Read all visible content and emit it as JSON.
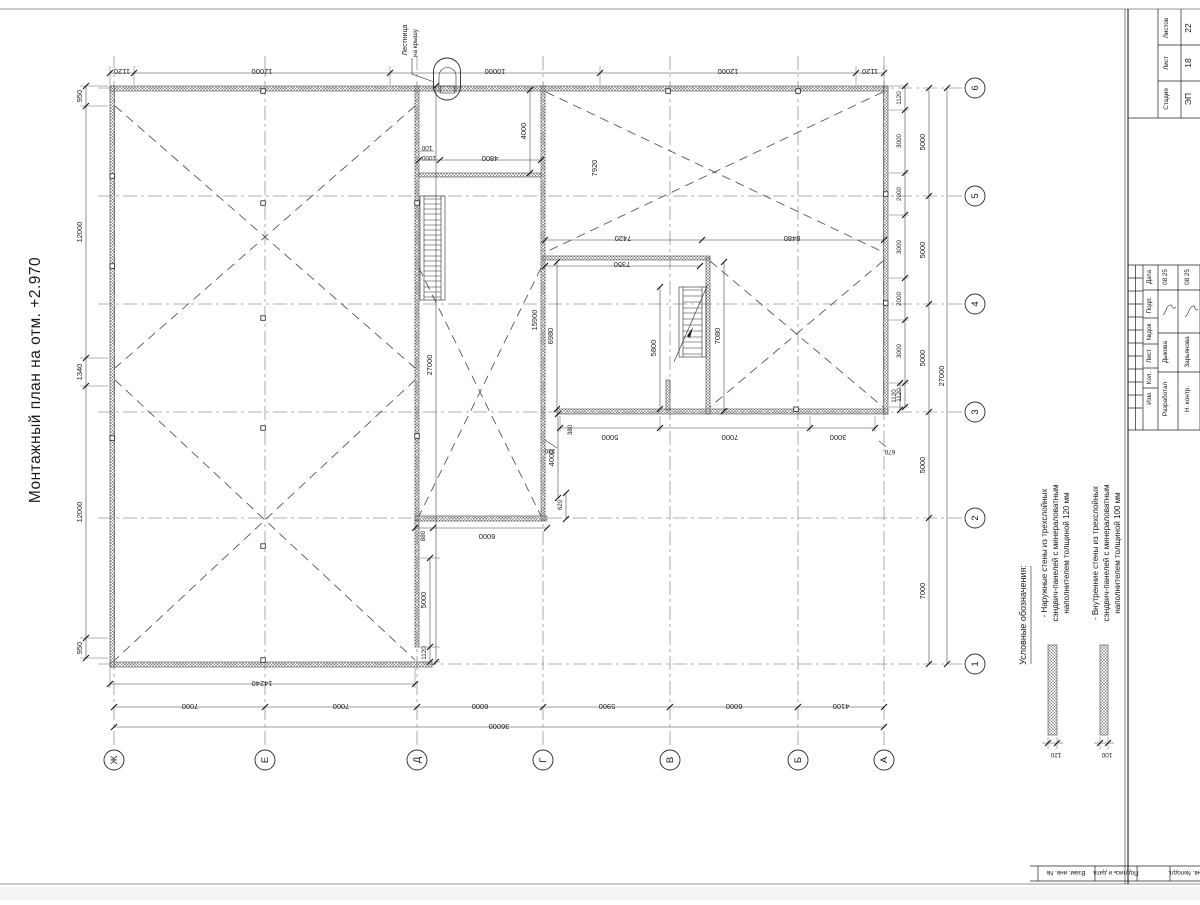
{
  "title": "Монтажный план на отм. +2.970",
  "roof_note": {
    "line1": "Лестница",
    "line2": "на крышу"
  },
  "grid": {
    "letters": [
      "Ж",
      "Е",
      "Д",
      "Г",
      "В",
      "Б",
      "А"
    ],
    "numbers": [
      "1",
      "2",
      "3",
      "4",
      "5",
      "6"
    ]
  },
  "dims": {
    "top": [
      "1120",
      "12000",
      "10000",
      "12000",
      "1120"
    ],
    "left": [
      "950",
      "12000",
      "1340",
      "12000",
      "950"
    ],
    "bottom": [
      "7000",
      "7000",
      "6000",
      "5900",
      "6000",
      "4100"
    ],
    "bottom_total": "36000",
    "hall_width": "14240",
    "right_inner": [
      "1120",
      "3000",
      "2000",
      "3000",
      "2000",
      "3000",
      "1120"
    ],
    "right_outer": [
      "5000",
      "5000",
      "5000",
      "5000",
      "7000"
    ],
    "right_total": "27000",
    "mid_total": "27000",
    "lower_chain": [
      "5000",
      "7000",
      "3000"
    ],
    "interior": {
      "h4000_top": "4000",
      "n100": "100",
      "w1000": "1000",
      "w4800": "4800",
      "h7920": "7920",
      "w7420": "7420",
      "w8480": "8480",
      "w7350": "7350",
      "h6980": "6980",
      "h5800": "5800",
      "h7080": "7080",
      "wall_len": "15900",
      "d380": "380",
      "d330": "330",
      "d670": "670",
      "d1120_r": "1120",
      "h4000_low": "4000",
      "d620": "620",
      "d880": "880",
      "w6000": "6000",
      "h5000_l": "5000",
      "d1120_l": "1120"
    }
  },
  "legend": {
    "heading": "Условные обозначения:",
    "items": [
      {
        "lines": [
          "- Наружные стены из трехслойных",
          "сэндвич-панелей с минераловатным",
          "наполнителем толщиной 120 мм"
        ],
        "label": "120"
      },
      {
        "lines": [
          "- Внутренние стены из трехслойных",
          "сэндвич-панелей с минераловатным",
          "наполнителем толщиной 100 мм"
        ],
        "label": "100"
      }
    ]
  },
  "title_block": {
    "stage_label": "Стадия",
    "sheet_label": "Лист",
    "sheets_label": "Листов",
    "stage": "ЭП",
    "sheet": "18",
    "sheets": "22",
    "columns": [
      "Изм.",
      "Кол.",
      "Лист",
      "№док",
      "Подп.",
      "Дата"
    ],
    "staff": [
      {
        "role": "Разработал",
        "name": "Дыкова",
        "date": "08.25"
      },
      {
        "role": "Н. контр.",
        "name": "Зарьянова",
        "date": "08.25"
      }
    ],
    "strip": [
      "Взам. инв. №",
      "Подпись и дата",
      "Инв. №подл."
    ]
  }
}
